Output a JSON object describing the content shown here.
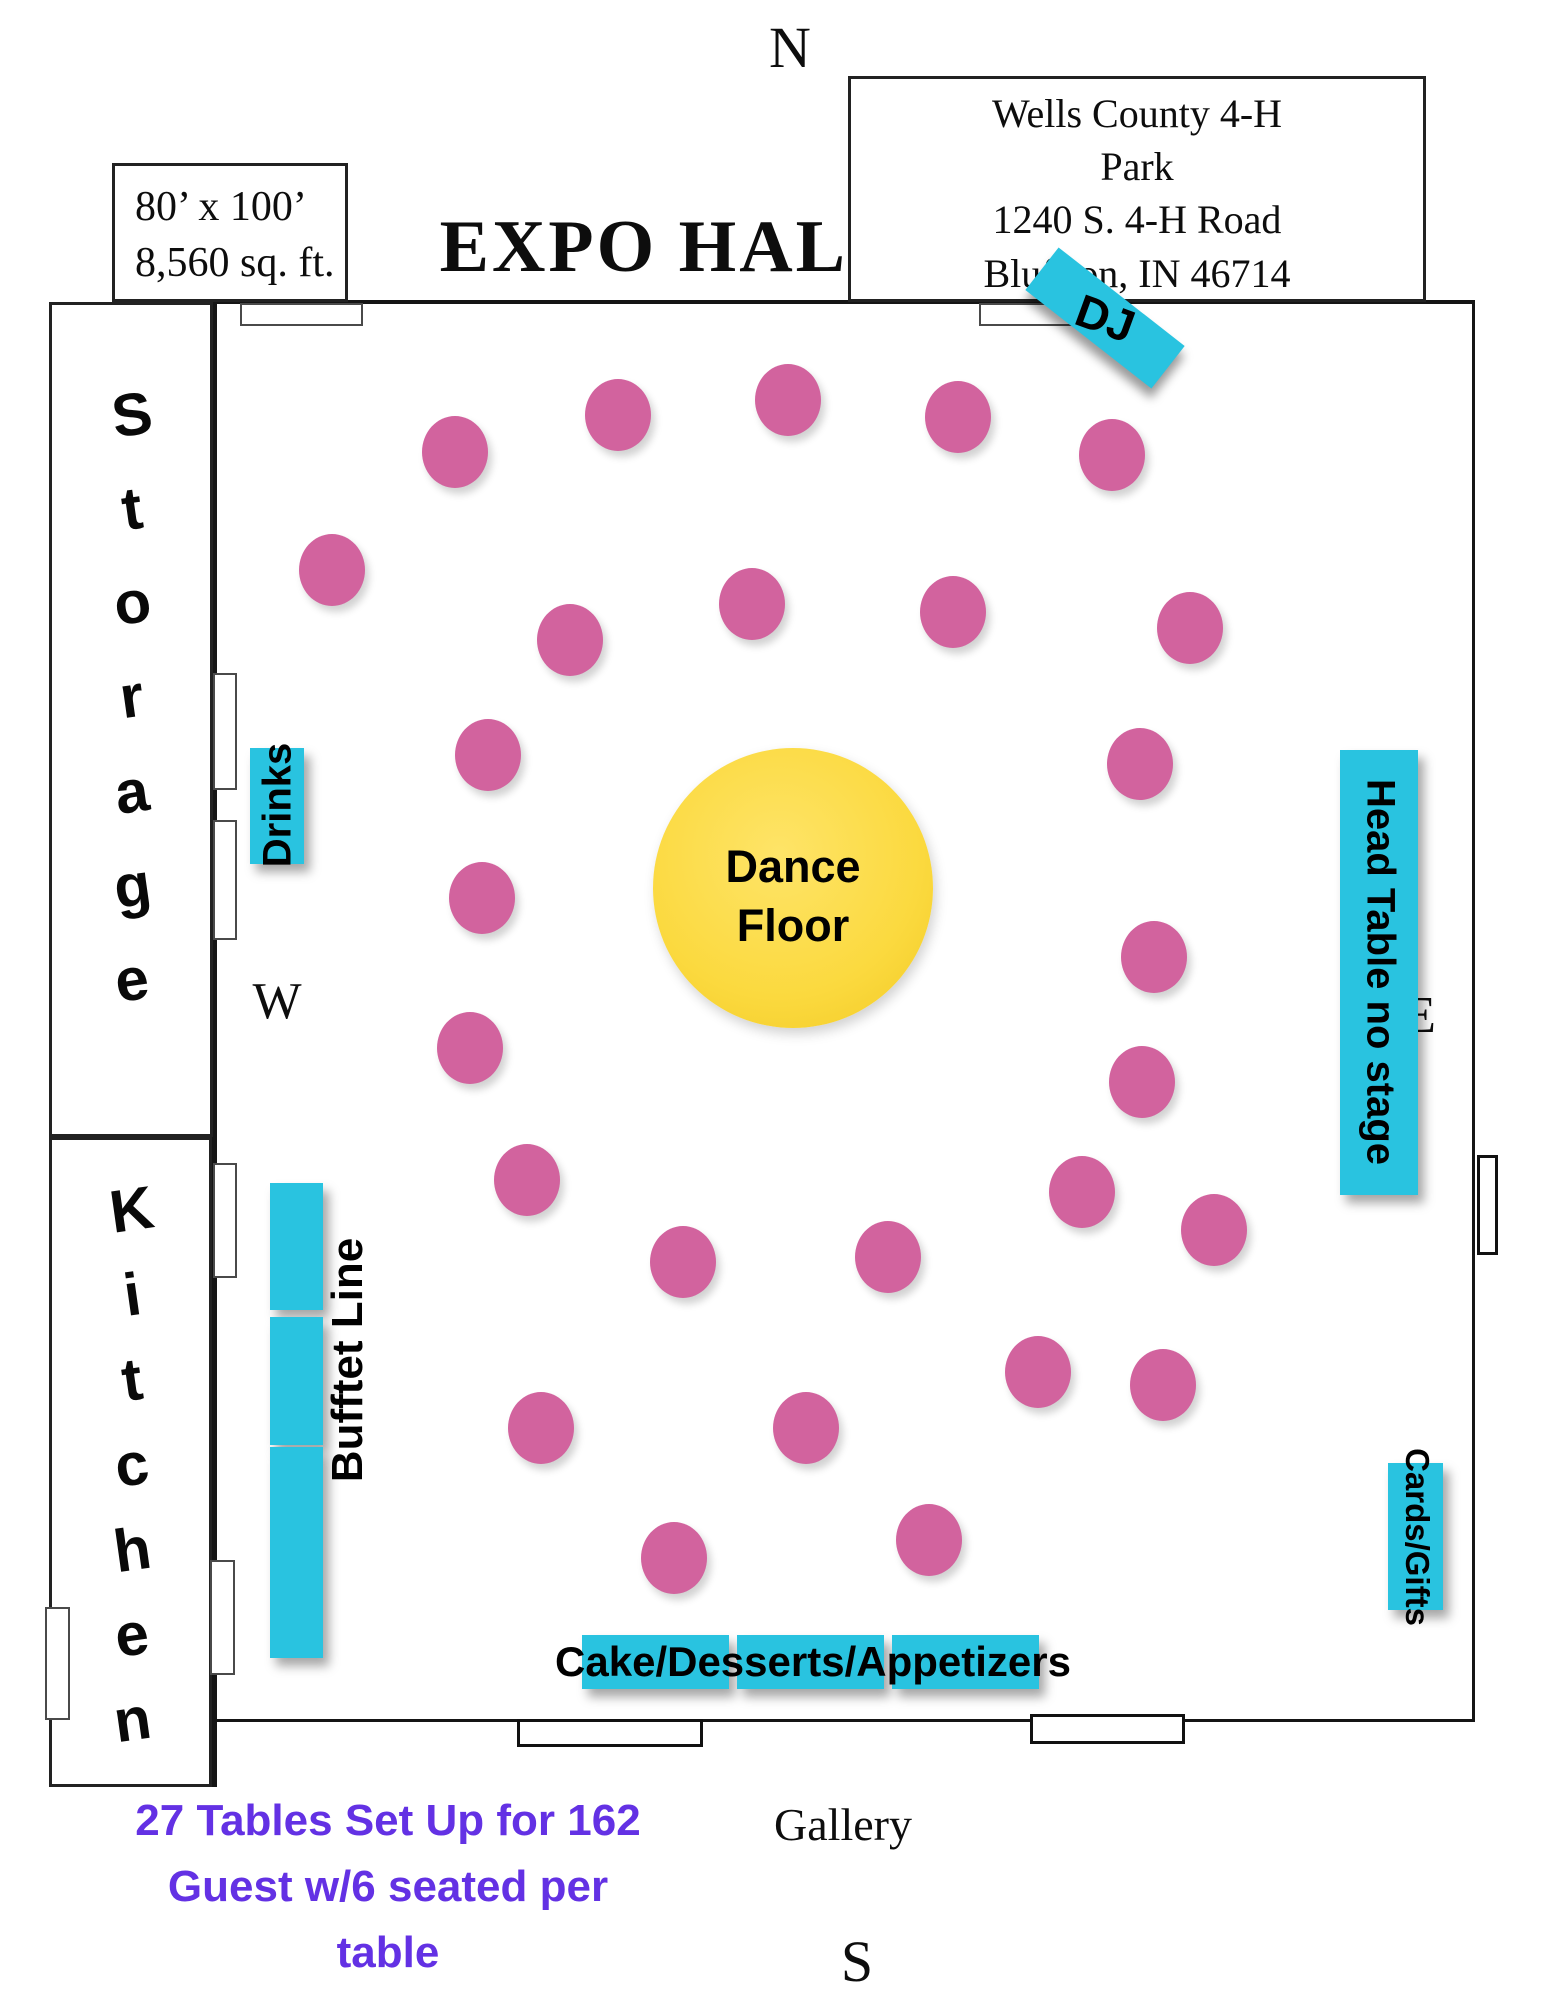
{
  "page": {
    "width": 1545,
    "height": 2000,
    "background": "#ffffff"
  },
  "colors": {
    "table_pink": "#d2639e",
    "label_cyan": "#29c3e0",
    "dance_floor_yellow": "#fbd93e",
    "note_purple": "#6331e4",
    "wall_black": "#151515"
  },
  "title": {
    "text": "EXPO HALL"
  },
  "compass": {
    "north": "N",
    "south": "S",
    "west": "W",
    "east": "E"
  },
  "info_box": {
    "line1": "80’ x 100’",
    "line2": "8,560 sq. ft."
  },
  "address_box": {
    "line1": "Wells County 4-H",
    "line2": "Park",
    "line3": "1240 S. 4-H Road",
    "line4": "Bluffton, IN  46714"
  },
  "areas": {
    "storage": "Storage",
    "kitchen": "Kitchen",
    "gallery": "Gallery",
    "dj": "DJ",
    "drinks": "Drinks",
    "head_table": "Head Table no stage",
    "cards_gifts": "Cards/Gifts",
    "buffet": "Bufftet Line",
    "cake": "Cake/Desserts/Appetizers",
    "dance_line1": "Dance",
    "dance_line2": "Floor"
  },
  "note": {
    "line1": "27 Tables Set Up for 162",
    "line2": "Guest w/6 seated per",
    "line3": "table"
  },
  "hall": {
    "left": 212,
    "top": 300,
    "right": 1475,
    "bottom": 1719
  },
  "dance_floor": {
    "cx": 793,
    "cy": 888,
    "radius": 140
  },
  "tables": {
    "count": 27,
    "positions": [
      {
        "x": 455,
        "y": 452
      },
      {
        "x": 618,
        "y": 415
      },
      {
        "x": 788,
        "y": 400
      },
      {
        "x": 958,
        "y": 417
      },
      {
        "x": 1112,
        "y": 455
      },
      {
        "x": 332,
        "y": 570
      },
      {
        "x": 570,
        "y": 640
      },
      {
        "x": 752,
        "y": 604
      },
      {
        "x": 953,
        "y": 612
      },
      {
        "x": 1190,
        "y": 628
      },
      {
        "x": 488,
        "y": 755
      },
      {
        "x": 1140,
        "y": 764
      },
      {
        "x": 482,
        "y": 898
      },
      {
        "x": 1154,
        "y": 957
      },
      {
        "x": 470,
        "y": 1048
      },
      {
        "x": 1142,
        "y": 1082
      },
      {
        "x": 527,
        "y": 1180
      },
      {
        "x": 683,
        "y": 1262
      },
      {
        "x": 888,
        "y": 1257
      },
      {
        "x": 1082,
        "y": 1192
      },
      {
        "x": 1214,
        "y": 1230
      },
      {
        "x": 1038,
        "y": 1372
      },
      {
        "x": 1163,
        "y": 1385
      },
      {
        "x": 541,
        "y": 1428
      },
      {
        "x": 806,
        "y": 1428
      },
      {
        "x": 929,
        "y": 1540
      },
      {
        "x": 674,
        "y": 1558
      }
    ]
  },
  "doors": [
    {
      "x": 240,
      "y": 303,
      "w": 123,
      "h": 23,
      "style": "light"
    },
    {
      "x": 979,
      "y": 303,
      "w": 126,
      "h": 23,
      "style": "light"
    },
    {
      "x": 517,
      "y": 1719,
      "w": 186,
      "h": 28,
      "style": "heavy"
    },
    {
      "x": 1030,
      "y": 1714,
      "w": 155,
      "h": 30,
      "style": "heavy"
    },
    {
      "x": 1477,
      "y": 1155,
      "w": 21,
      "h": 100,
      "style": "heavy"
    },
    {
      "x": 213,
      "y": 673,
      "w": 24,
      "h": 117,
      "style": "light"
    },
    {
      "x": 213,
      "y": 820,
      "w": 24,
      "h": 120,
      "style": "light"
    },
    {
      "x": 213,
      "y": 1163,
      "w": 24,
      "h": 115,
      "style": "light"
    },
    {
      "x": 210,
      "y": 1560,
      "w": 25,
      "h": 115,
      "style": "light"
    },
    {
      "x": 45,
      "y": 1607,
      "w": 25,
      "h": 113,
      "style": "light"
    }
  ],
  "buffet_rects": [
    {
      "x": 270,
      "y": 1183,
      "w": 53,
      "h": 127
    },
    {
      "x": 270,
      "y": 1317,
      "w": 53,
      "h": 128
    },
    {
      "x": 270,
      "y": 1447,
      "w": 53,
      "h": 211
    }
  ],
  "cake_rects": [
    {
      "x": 582,
      "y": 1635,
      "w": 147,
      "h": 54
    },
    {
      "x": 737,
      "y": 1635,
      "w": 147,
      "h": 54
    },
    {
      "x": 892,
      "y": 1635,
      "w": 147,
      "h": 54
    }
  ]
}
